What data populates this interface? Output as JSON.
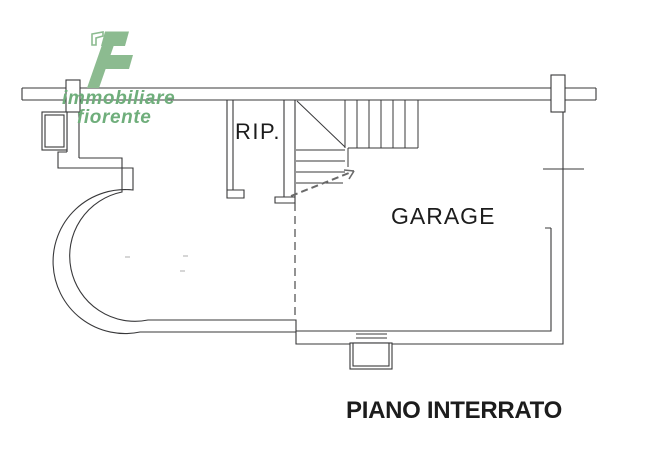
{
  "logo": {
    "icon": "immobiliare-fiorente-f-logo",
    "line1": "immobiliare",
    "line2": "fiorente"
  },
  "labels": {
    "storage_room": "RIP.",
    "garage": "GARAGE"
  },
  "caption": "PIANO INTERRATO",
  "colors": {
    "logo_green_fill": "#8cbb90",
    "logo_green_text": "#6fae7b",
    "plan_line": "#38383a",
    "background": "#ffffff"
  }
}
